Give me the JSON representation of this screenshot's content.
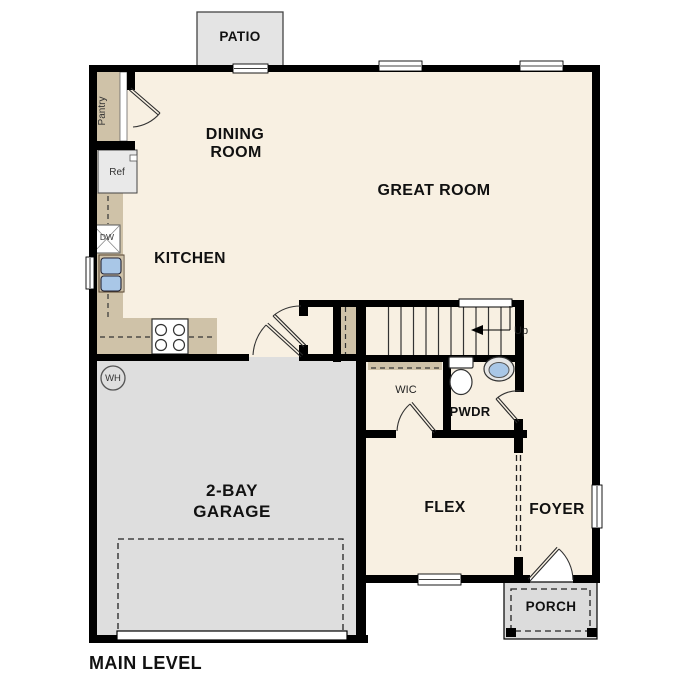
{
  "plan": {
    "footer_title": "MAIN LEVEL",
    "rooms": {
      "patio": "PATIO",
      "dining_line1": "DINING",
      "dining_line2": "ROOM",
      "great_room": "GREAT ROOM",
      "kitchen": "KITCHEN",
      "pantry": "Pantry",
      "garage_line1": "2-BAY",
      "garage_line2": "GARAGE",
      "flex": "FLEX",
      "foyer": "FOYER",
      "wic": "WIC",
      "pwdr": "PWDR",
      "porch": "PORCH"
    },
    "fixtures": {
      "ref": "Ref",
      "dw": "DW",
      "wh": "WH",
      "up": "Up"
    },
    "colors": {
      "floor": "#f8f0e2",
      "counter": "#cfc2a8",
      "garage_floor": "#dedede",
      "porch_floor": "#dcdcdc",
      "patio_floor": "#e4e4e4",
      "wall": "#000000",
      "sink_blue": "#a9c7e7",
      "appliance_gray": "#e9e9e9",
      "text": "#111111"
    }
  }
}
